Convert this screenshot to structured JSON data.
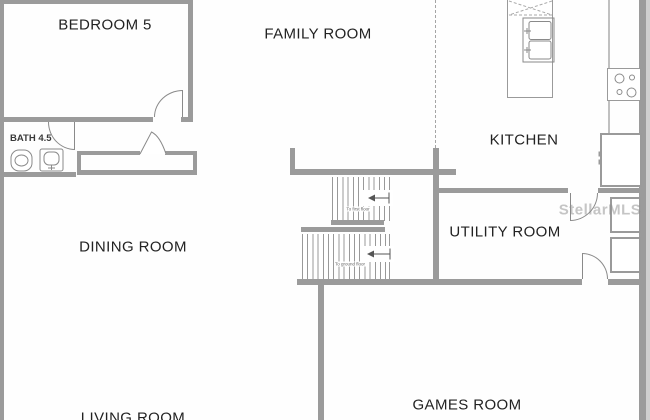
{
  "watermark": "StellarMLS",
  "rooms": [
    {
      "id": "bedroom5",
      "label": "BEDROOM 5"
    },
    {
      "id": "family-room",
      "label": "FAMILY ROOM"
    },
    {
      "id": "kitchen",
      "label": "KITCHEN"
    },
    {
      "id": "bath",
      "label": "BATH 4.5"
    },
    {
      "id": "dining-room",
      "label": "DINING ROOM"
    },
    {
      "id": "utility-room",
      "label": "UTILITY ROOM"
    },
    {
      "id": "games-room",
      "label": "GAMES ROOM"
    },
    {
      "id": "living-room",
      "label": "LIVING ROOM"
    }
  ],
  "stairs": {
    "to_first": "To first floor",
    "to_ground": "To ground floor"
  },
  "fixtures": [
    "toilet",
    "bathroom-sink",
    "closet",
    "kitchen-island-double-sink",
    "cooktop",
    "refrigerator",
    "washer",
    "dryer",
    "staircase"
  ],
  "colors": {
    "wall": "#9b9b9b",
    "line": "#999999",
    "text": "#222222",
    "watermark_text": "rgba(140,140,140,0.5)",
    "background": "#fefefe"
  }
}
